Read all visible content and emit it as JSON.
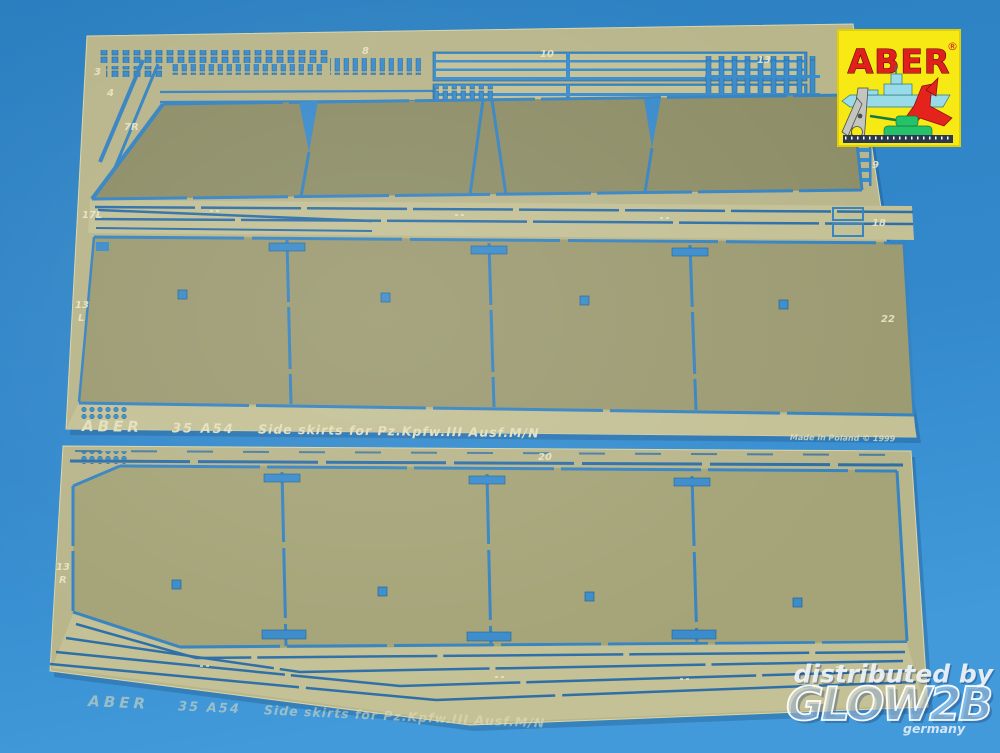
{
  "colors": {
    "background_blue": "#2f86c6",
    "sheet_brass": "#b9b68c",
    "panel_olive": "#9c9b72",
    "panel_dark_olive": "#8e8f68",
    "rail_light": "#c4c196",
    "cutout_blue": "#3b8ccb",
    "etched_text": "#e8e4c4",
    "logo_yellow": "#f6e914",
    "logo_red": "#e1201e"
  },
  "logo": {
    "brand": "ABER",
    "registered": "®"
  },
  "sheet": {
    "brand": "ABER",
    "code": "35 A54",
    "title": "Side skirts for Pz.Kpfw.III Ausf.M/N",
    "origin": "Made in Poland © 1999"
  },
  "part_labels": [
    "3",
    "4",
    "7R",
    "8",
    "10",
    "13",
    "9",
    "17L",
    "18",
    "13",
    "L",
    "22",
    "20",
    "13",
    "R"
  ],
  "watermark": {
    "line1": "distributed by",
    "brand": "GLOW2B",
    "country": "germany"
  }
}
